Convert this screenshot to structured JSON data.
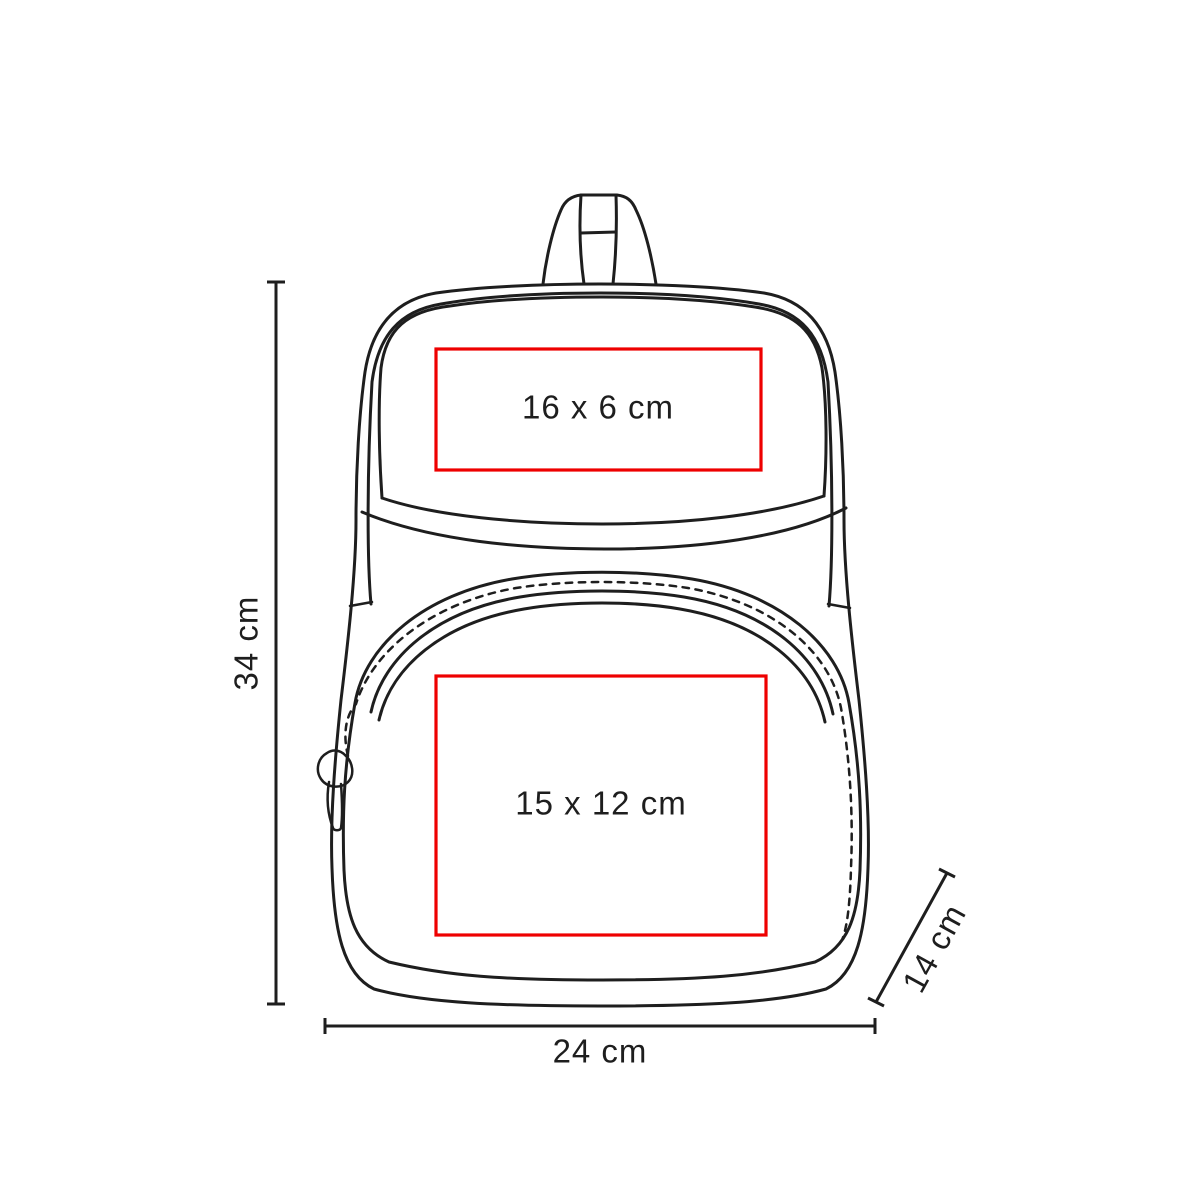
{
  "diagram": {
    "product": "backpack",
    "colors": {
      "line": "#1e1e1e",
      "print_area": "#ee0000"
    },
    "dimensions": {
      "height": "34 cm",
      "width": "24 cm",
      "depth": "14 cm"
    },
    "print_areas": [
      {
        "id": "top-pocket",
        "label": "16 x 6 cm"
      },
      {
        "id": "front-pocket",
        "label": "15 x 12 cm"
      }
    ]
  }
}
